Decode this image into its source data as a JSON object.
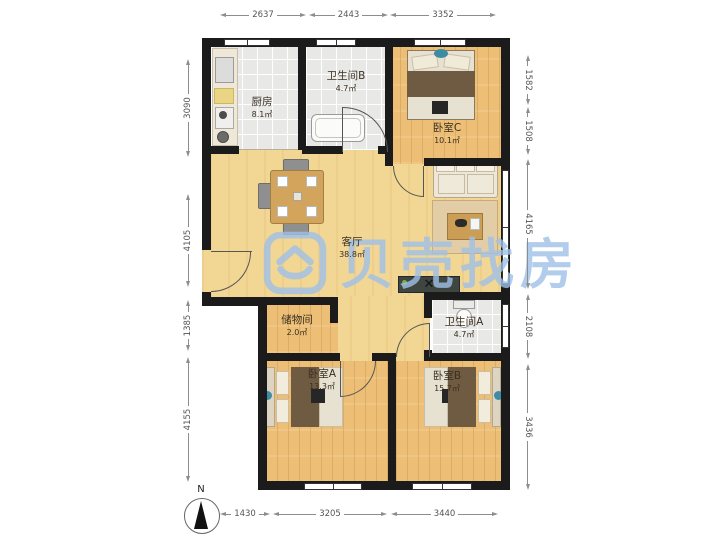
{
  "watermark": {
    "brand": "贝壳找房"
  },
  "compass": {
    "label": "N"
  },
  "rooms": [
    {
      "name": "厨房",
      "area": "8.1㎡"
    },
    {
      "name": "卫生间B",
      "area": "4.7㎡"
    },
    {
      "name": "卧室C",
      "area": "10.1㎡"
    },
    {
      "name": "客厅",
      "area": "38.8㎡"
    },
    {
      "name": "储物间",
      "area": "2.0㎡"
    },
    {
      "name": "卫生间A",
      "area": "4.7㎡"
    },
    {
      "name": "卧室A",
      "area": "13.3㎡"
    },
    {
      "name": "卧室B",
      "area": "15.7㎡"
    }
  ],
  "dimensions": {
    "top": [
      "2637",
      "2443",
      "3352"
    ],
    "bottom": [
      "1430",
      "3205",
      "3440"
    ],
    "left": [
      "3090",
      "4105",
      "1385",
      "4155"
    ],
    "right": [
      "1582",
      "1508",
      "4165",
      "2108",
      "3436"
    ]
  },
  "colors": {
    "wall": "#1b1b1b",
    "wood_floor": "#edbf76",
    "tile_floor": "#e8e8e6",
    "watermark": "#9fc1e8"
  }
}
